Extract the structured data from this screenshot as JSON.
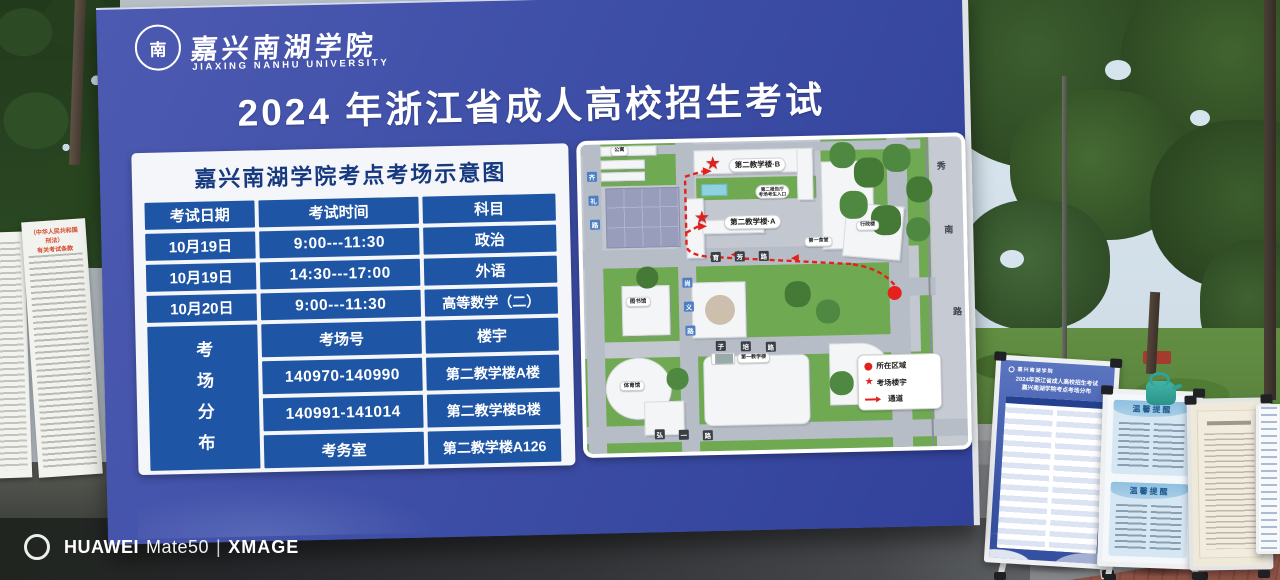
{
  "billboard": {
    "logo": {
      "emblem_char": "南",
      "name_cn": "嘉兴南湖学院",
      "name_en": "JIAXING NANHU UNIVERSITY"
    },
    "title": "2024 年浙江省成人高校招生考试",
    "schedule": {
      "panel_title": "嘉兴南湖学院考点考场示意图",
      "headers": [
        "考试日期",
        "考试时间",
        "科目"
      ],
      "rows": [
        [
          "10月19日",
          "9:00---11:30",
          "政治"
        ],
        [
          "10月19日",
          "14:30---17:00",
          "外语"
        ],
        [
          "10月20日",
          "9:00---11:30",
          "高等数学（二）"
        ]
      ],
      "distribution_title": "考场分布",
      "distribution_headers": [
        "考场号",
        "楼宇"
      ],
      "distribution_rows": [
        [
          "140970-140990",
          "第二教学楼A楼"
        ],
        [
          "140991-141014",
          "第二教学楼B楼"
        ],
        [
          "考务室",
          "第二教学楼A126"
        ]
      ]
    },
    "map": {
      "building_b_label": "第二教学楼·B",
      "building_a_label": "第二教学楼·A",
      "entrance_label_line1": "第二报告厅",
      "entrance_label_line2": "考场考生入口",
      "first_canteen_label": "第一食堂",
      "first_teaching_label": "第一教学楼",
      "library_label": "图书馆",
      "gym_label": "体育馆",
      "apartment_label": "公寓",
      "admin_label": "行政楼",
      "road_yufang": [
        "育",
        "芳",
        "路"
      ],
      "road_zipei": [
        "子",
        "培",
        "路"
      ],
      "road_hongyi": [
        "弘",
        "一",
        "路"
      ],
      "road_qili": [
        "齐",
        "礼",
        "路"
      ],
      "road_shangyi": [
        "尚",
        "义",
        "路"
      ],
      "road_xiunan": [
        "秀",
        "南",
        "路"
      ],
      "legend": {
        "current_area": "所在区域",
        "exam_building": "考场楼宇",
        "passage": "通道"
      }
    }
  },
  "left_sign": {
    "title_line1": "（中华人民共和国刑法）",
    "title_line2": "有关考试条款"
  },
  "stands": {
    "blue_board": {
      "logo": "嘉兴南湖学院",
      "title_line1": "2024年浙江省成人高校招生考试",
      "title_line2": "嘉兴南湖学院考点考场分布"
    },
    "reminder_title": "温馨提醒"
  },
  "watermark": {
    "brand": "HUAWEI",
    "model": "Mate50",
    "separator": "|",
    "engine": "XMAGE"
  },
  "colors": {
    "board_blue": "#3e4fa7",
    "cell_blue": "#1f55a5",
    "panel_title_blue": "#16397f",
    "red": "#e0221e"
  }
}
